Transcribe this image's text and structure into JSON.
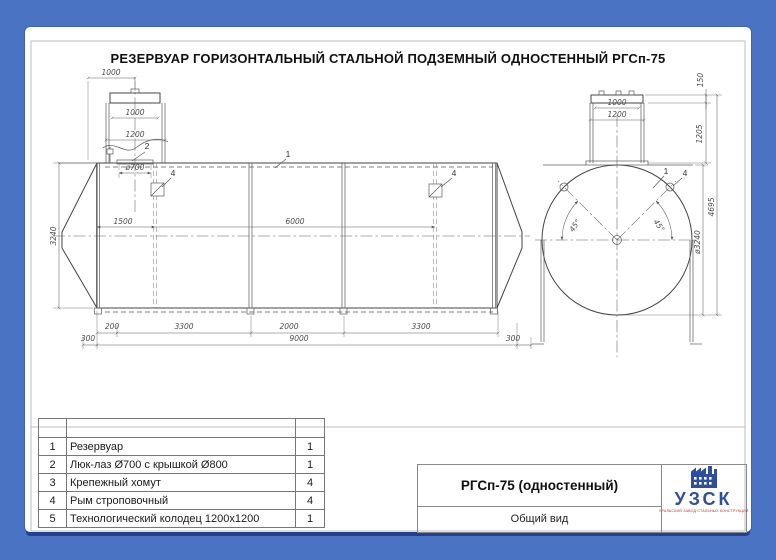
{
  "page": {
    "title": "РЕЗЕРВУАР ГОРИЗОНТАЛЬНЫЙ СТАЛЬНОЙ ПОДЗЕМНЫЙ ОДНОСТЕННЫЙ РГСп-75"
  },
  "colors": {
    "frame_blue": "#4a73c4",
    "page_shadow": "#23408f",
    "logo_blue": "#2f4f9e",
    "logo_red": "#cc2a20",
    "drawing_line": "#454545"
  },
  "side_view": {
    "dims": {
      "well_offset": "1000",
      "well_cover_width": "1000",
      "well_width": "1200",
      "hatch_diameter": "ø700",
      "tank_height": "3240",
      "to_first_lug": "1500",
      "between_lugs": "6000",
      "seg_200": "200",
      "seg_3300a": "3300",
      "seg_2000": "2000",
      "seg_3300b": "3300",
      "end_300_left": "300",
      "cylinder_9000": "9000",
      "end_300_right": "300"
    },
    "callouts": {
      "tank": "1",
      "hatch": "2",
      "lug_left": "4",
      "lug_right": "4"
    }
  },
  "end_view": {
    "dims": {
      "cover_height": "150",
      "neck_cover_width": "1000",
      "neck_width": "1200",
      "neck_height": "1205",
      "total_height": "4695",
      "diameter": "ø3240",
      "angle_left": "45°",
      "angle_right": "45°"
    },
    "callouts": {
      "tank": "1",
      "lug": "4"
    }
  },
  "parts_table": {
    "rows": [
      {
        "num": "1",
        "name": "Резервуар",
        "qty": "1"
      },
      {
        "num": "2",
        "name": "Люк-лаз Ø700 с крышкой Ø800",
        "qty": "1"
      },
      {
        "num": "3",
        "name": "Крепежный хомут",
        "qty": "4"
      },
      {
        "num": "4",
        "name": "Рым строповочный",
        "qty": "4"
      },
      {
        "num": "5",
        "name": "Технологический колодец 1200x1200",
        "qty": "1"
      }
    ]
  },
  "title_block": {
    "model": "РГСп-75 (одностенный)",
    "view_name": "Общий вид"
  },
  "logo": {
    "name": "УЗСК",
    "tagline": "УРАЛЬСКИЙ ЗАВОД СТАЛЬНЫХ КОНСТРУКЦИЙ"
  }
}
